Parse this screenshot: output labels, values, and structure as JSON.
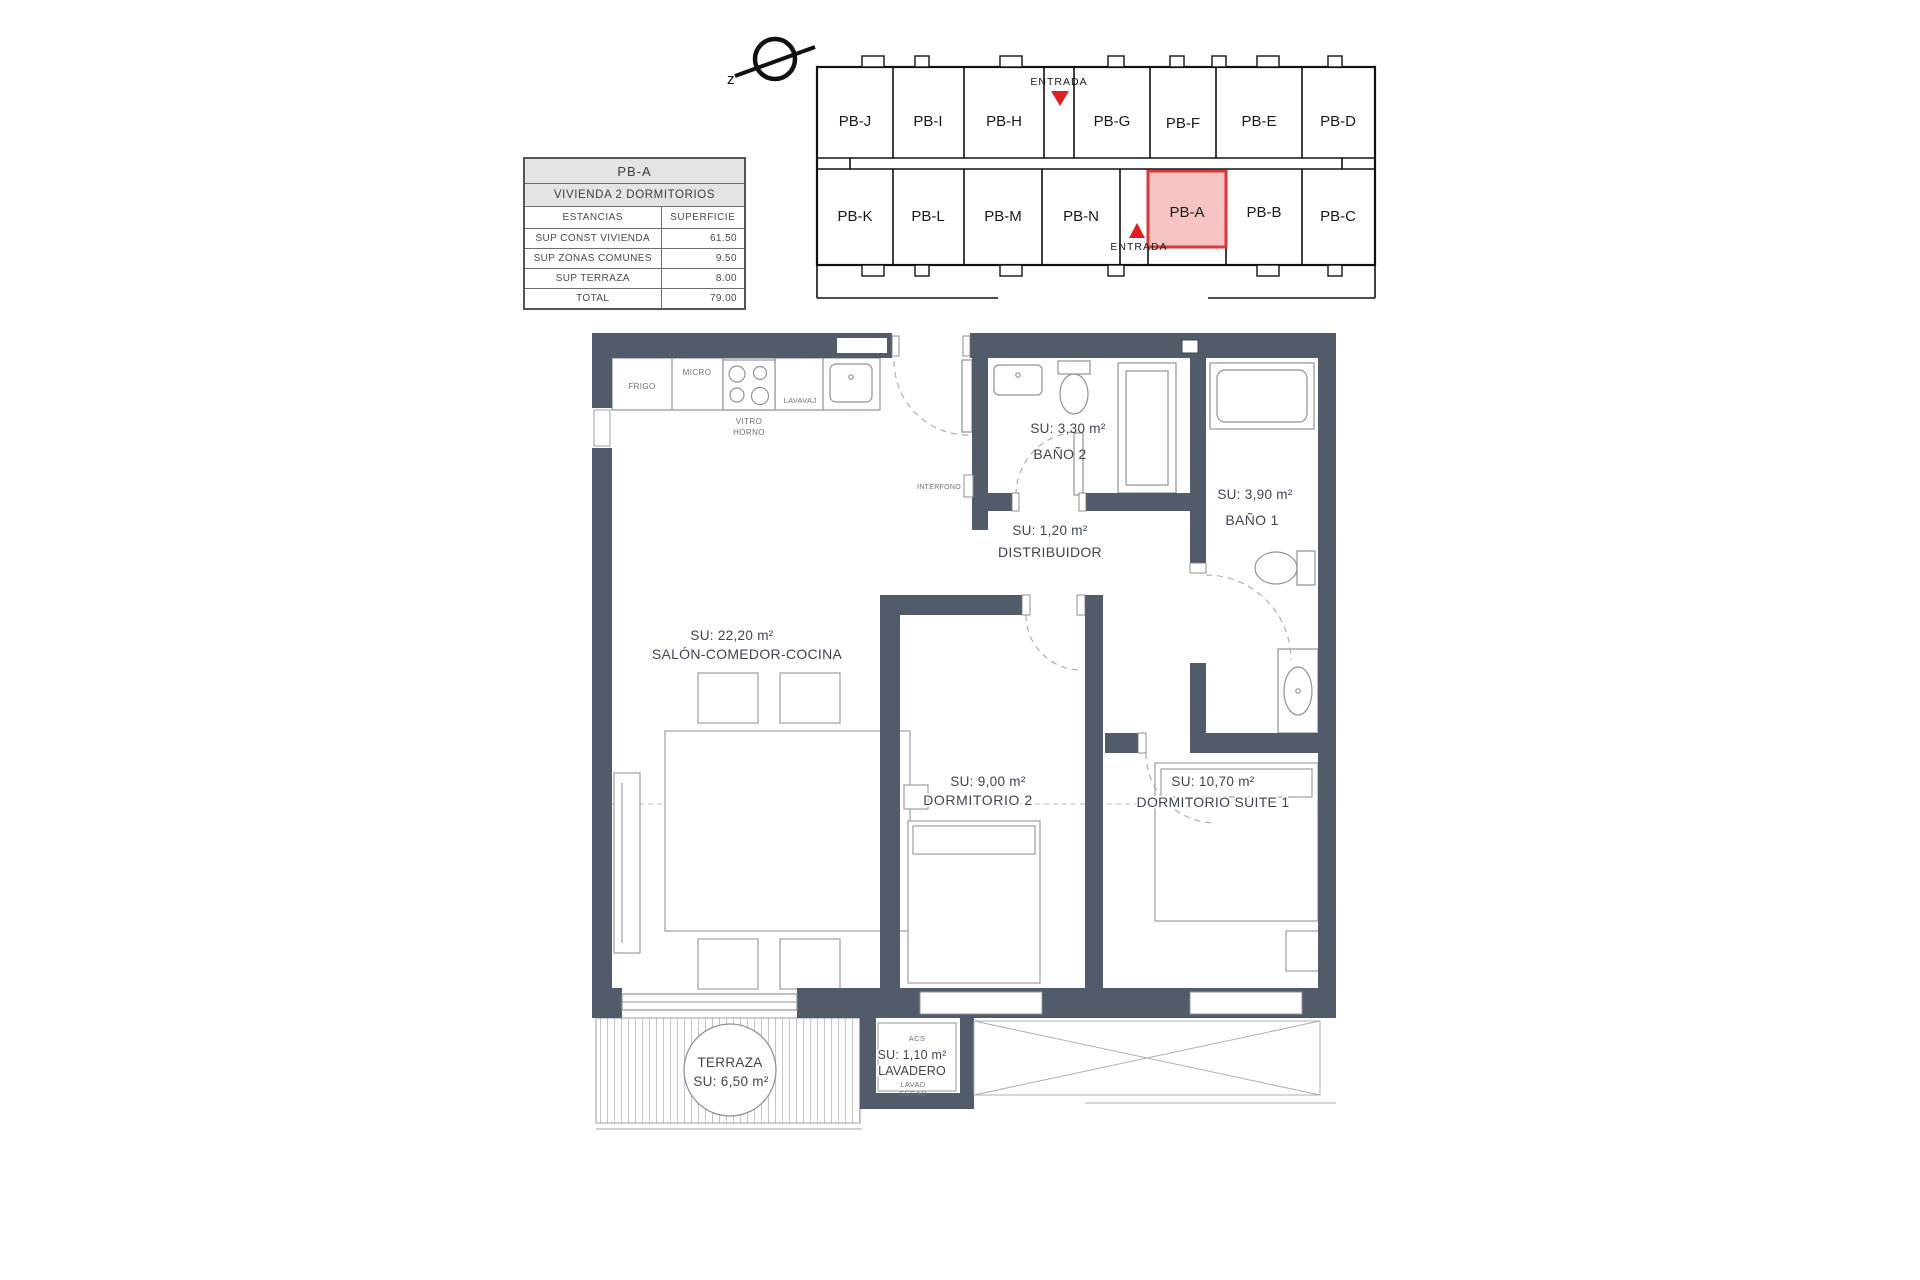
{
  "compass": {
    "letter": "z"
  },
  "info_table": {
    "unit": "PB-A",
    "subtitle": "VIVIENDA 2 DORMITORIOS",
    "col_estancias": "ESTANCIAS",
    "col_superficie": "SUPERFICIE",
    "rows": [
      {
        "label": "SUP CONST VIVIENDA",
        "value": "61.50"
      },
      {
        "label": "SUP ZONAS COMUNES",
        "value": "9.50"
      },
      {
        "label": "SUP TERRAZA",
        "value": "8.00"
      },
      {
        "label": "TOTAL",
        "value": "79.00"
      }
    ]
  },
  "key_plan": {
    "entrada_top": "ENTRADA",
    "entrada_bottom": "ENTRADA",
    "top_row": [
      "PB-J",
      "PB-I",
      "PB-H",
      "PB-G",
      "PB-F",
      "PB-E",
      "PB-D"
    ],
    "bottom_row": [
      "PB-K",
      "PB-L",
      "PB-M",
      "PB-N",
      "PB-A",
      "PB-B",
      "PB-C"
    ],
    "highlight_unit": "PB-A",
    "highlight_fill": "#f5b9b9",
    "highlight_border": "#d63a3a",
    "arrow_color": "#e01f1f"
  },
  "floor_plan": {
    "wall_color": "#515b69",
    "rooms": {
      "salon": {
        "area": "SU: 22,20 m²",
        "name": "SALÓN-COMEDOR-COCINA"
      },
      "bano2": {
        "area": "SU: 3,30 m²",
        "name": "BAÑO 2"
      },
      "bano1": {
        "area": "SU: 3,90 m²",
        "name": "BAÑO 1"
      },
      "distribuidor": {
        "area": "SU: 1,20 m²",
        "name": "DISTRIBUIDOR"
      },
      "dormitorio2": {
        "area": "SU: 9,00 m²",
        "name": "DORMITORIO 2"
      },
      "suite": {
        "area": "SU: 10,70 m²",
        "name": "DORMITORIO SUITE 1"
      },
      "terraza": {
        "name": "TERRAZA",
        "area": "SU: 6,50 m²"
      },
      "lavadero": {
        "area": "SU: 1,10 m²",
        "name": "LAVADERO"
      }
    },
    "kitchen": {
      "frigo": "FRIGO",
      "micro": "MICRO",
      "lavavaj": "LAVAVAJ",
      "vitro": "VITRO",
      "horno": "HORNO"
    },
    "misc": {
      "interfono": "INTERFONO",
      "acs": "ACS",
      "lavad": "LAVAD",
      "secad": "SECAD"
    }
  }
}
